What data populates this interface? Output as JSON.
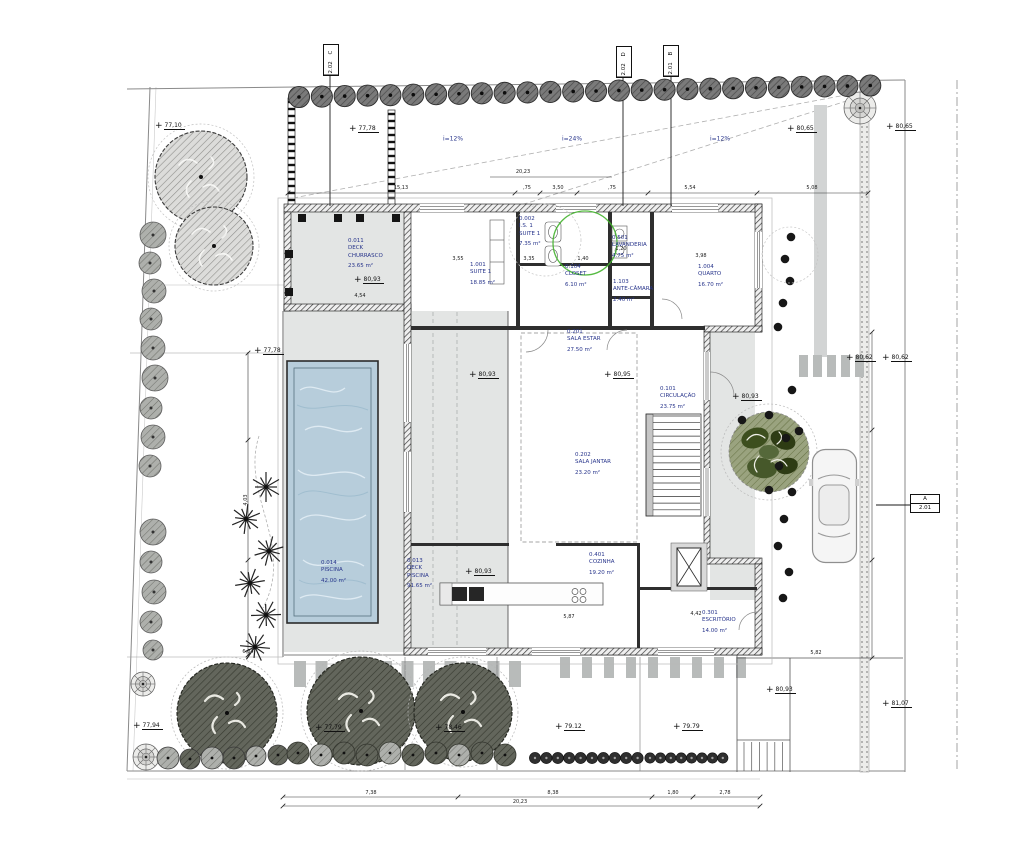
{
  "drawing": {
    "type": "residential floor / site plan",
    "colors": {
      "label_blue": "#27348b",
      "pool_blue": "#b7cddb",
      "deck_gray": "#e3e5e4",
      "accent_green": "#43b22c",
      "line": "#1c1c1e"
    },
    "rooms": [
      {
        "code": "0.011",
        "name": "DECK\nCHURRASCO",
        "area": "23.65 m²",
        "x": 348,
        "y": 238
      },
      {
        "code": "1.001",
        "name": "SUITE 1",
        "area": "18.85 m²",
        "x": 470,
        "y": 262
      },
      {
        "code": "0.002",
        "name": "I.S. 1\nSUITE 1",
        "area": "7.35 m²",
        "x": 519,
        "y": 216
      },
      {
        "code": "0.104",
        "name": "CLOSET",
        "area": "6.10 m²",
        "x": 565,
        "y": 264
      },
      {
        "code": "0.501",
        "name": "LAVANDERIA",
        "area": "4.75 m²",
        "x": 612,
        "y": 235
      },
      {
        "code": "1.103",
        "name": "ANTE-CÂMARA",
        "area": "2.40 m²",
        "x": 613,
        "y": 279
      },
      {
        "code": "1.004",
        "name": "QUARTO",
        "area": "16.70 m²",
        "x": 698,
        "y": 264
      },
      {
        "code": "0.201",
        "name": "SALA ESTAR",
        "area": "27.50 m²",
        "x": 567,
        "y": 329
      },
      {
        "code": "0.101",
        "name": "CIRCULAÇÃO",
        "area": "23.75 m²",
        "x": 660,
        "y": 386
      },
      {
        "code": "0.202",
        "name": "SALA JANTAR",
        "area": "23.20 m²",
        "x": 575,
        "y": 452
      },
      {
        "code": "0.401",
        "name": "COZINHA",
        "area": "19.20 m²",
        "x": 589,
        "y": 552
      },
      {
        "code": "0.301",
        "name": "ESCRITÓRIO",
        "area": "14.00 m²",
        "x": 702,
        "y": 610
      },
      {
        "code": "0.013",
        "name": "DECK\nPISCINA",
        "area": "91.65 m²",
        "x": 407,
        "y": 558
      },
      {
        "code": "0.014",
        "name": "PISCINA",
        "area": "42.00 m²",
        "x": 321,
        "y": 560
      }
    ],
    "levels": [
      {
        "v": "77,10",
        "x": 155,
        "y": 121
      },
      {
        "v": "77,78",
        "x": 349,
        "y": 124
      },
      {
        "v": "80,65",
        "x": 787,
        "y": 124
      },
      {
        "v": "80,65",
        "x": 886,
        "y": 122
      },
      {
        "v": "77,78",
        "x": 254,
        "y": 346
      },
      {
        "v": "80,93",
        "x": 354,
        "y": 275
      },
      {
        "v": "80,93",
        "x": 469,
        "y": 370
      },
      {
        "v": "80,95",
        "x": 604,
        "y": 370
      },
      {
        "v": "80,93",
        "x": 732,
        "y": 392
      },
      {
        "v": "80,62",
        "x": 846,
        "y": 353
      },
      {
        "v": "80,62",
        "x": 882,
        "y": 353
      },
      {
        "v": "80,93",
        "x": 465,
        "y": 567
      },
      {
        "v": "79.12",
        "x": 555,
        "y": 722
      },
      {
        "v": "79.79",
        "x": 673,
        "y": 722
      },
      {
        "v": "80,93",
        "x": 766,
        "y": 685
      },
      {
        "v": "81,07",
        "x": 882,
        "y": 699
      },
      {
        "v": "77,94",
        "x": 133,
        "y": 721
      },
      {
        "v": "77,79",
        "x": 315,
        "y": 723
      },
      {
        "v": "78,46",
        "x": 435,
        "y": 723
      }
    ],
    "sections": [
      {
        "letter": "C",
        "sheet": "2.02",
        "orient": "v",
        "x": 323,
        "y": 44
      },
      {
        "letter": "D",
        "sheet": "2.02",
        "orient": "v",
        "x": 616,
        "y": 46
      },
      {
        "letter": "B",
        "sheet": "2.01",
        "orient": "v",
        "x": 663,
        "y": 45
      },
      {
        "letter": "A",
        "sheet": "2.01",
        "orient": "h",
        "x": 910,
        "y": 494
      }
    ],
    "slopes": [
      {
        "t": "i=12%",
        "x": 453,
        "y": 139
      },
      {
        "t": "i=24%",
        "x": 572,
        "y": 139
      },
      {
        "t": "i=12%",
        "x": 720,
        "y": 139
      }
    ],
    "dims": [
      {
        "t": "20,23",
        "x": 523,
        "y": 175
      },
      {
        "t": "15,13",
        "x": 401,
        "y": 191
      },
      {
        "t": ",75",
        "x": 527,
        "y": 191
      },
      {
        "t": "3,50",
        "x": 558,
        "y": 191
      },
      {
        "t": ",75",
        "x": 612,
        "y": 191
      },
      {
        "t": "5,54",
        "x": 690,
        "y": 191
      },
      {
        "t": "5,08",
        "x": 812,
        "y": 191
      },
      {
        "t": "3,55",
        "x": 458,
        "y": 262
      },
      {
        "t": "3,35",
        "x": 529,
        "y": 262
      },
      {
        "t": "1,40",
        "x": 583,
        "y": 262
      },
      {
        "t": "3,98",
        "x": 701,
        "y": 259
      },
      {
        "t": "1,20",
        "x": 621,
        "y": 252
      },
      {
        "t": "4,54",
        "x": 360,
        "y": 299
      },
      {
        "t": "4,03",
        "x": 246,
        "y": 500,
        "rot": 1
      },
      {
        "t": "5,87",
        "x": 569,
        "y": 620
      },
      {
        "t": "4,42",
        "x": 696,
        "y": 617
      },
      {
        "t": "6,04",
        "x": 248,
        "y": 655
      },
      {
        "t": "5,82",
        "x": 816,
        "y": 656
      },
      {
        "t": "7,38",
        "x": 371,
        "y": 796
      },
      {
        "t": "8,38",
        "x": 553,
        "y": 796
      },
      {
        "t": "1,80",
        "x": 673,
        "y": 796
      },
      {
        "t": "2,78",
        "x": 725,
        "y": 796
      },
      {
        "t": "20,23",
        "x": 520,
        "y": 805
      }
    ]
  }
}
